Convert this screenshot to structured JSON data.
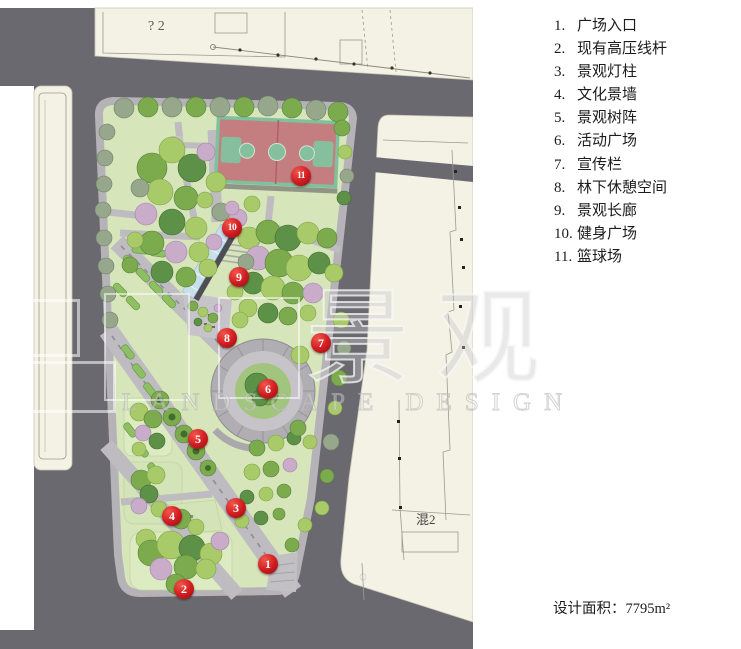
{
  "legend": {
    "items": [
      {
        "num": "1.",
        "label": "广场入口"
      },
      {
        "num": "2.",
        "label": "现有高压线杆"
      },
      {
        "num": "3.",
        "label": "景观灯柱"
      },
      {
        "num": "4.",
        "label": "文化景墙"
      },
      {
        "num": "5.",
        "label": "景观树阵"
      },
      {
        "num": "6.",
        "label": "活动广场"
      },
      {
        "num": "7.",
        "label": "宣传栏"
      },
      {
        "num": "8.",
        "label": "林下休憩空间"
      },
      {
        "num": "9.",
        "label": "景观长廊"
      },
      {
        "num": "10.",
        "label": "健身广场"
      },
      {
        "num": "11.",
        "label": "篮球场"
      }
    ]
  },
  "area_note": "设计面积：7795m²",
  "map": {
    "texts": {
      "q2": "? 2",
      "hun": "混2"
    },
    "watermark": {
      "cn1": "景",
      "cn2": "观",
      "en": "LANDSCAPE DESIGN"
    },
    "markers": [
      {
        "n": "1",
        "x": 268,
        "y": 564,
        "label": "广场入口"
      },
      {
        "n": "2",
        "x": 184,
        "y": 589,
        "label": "现有高压线杆"
      },
      {
        "n": "3",
        "x": 236,
        "y": 508,
        "label": "景观灯柱"
      },
      {
        "n": "4",
        "x": 172,
        "y": 516,
        "label": "文化景墙"
      },
      {
        "n": "5",
        "x": 198,
        "y": 439,
        "label": "景观树阵"
      },
      {
        "n": "6",
        "x": 268,
        "y": 389,
        "label": "活动广场"
      },
      {
        "n": "7",
        "x": 321,
        "y": 343,
        "label": "宣传栏"
      },
      {
        "n": "8",
        "x": 227,
        "y": 338,
        "label": "林下休憩空间"
      },
      {
        "n": "9",
        "x": 239,
        "y": 277,
        "label": "景观长廊"
      },
      {
        "n": "10",
        "x": 232,
        "y": 228,
        "label": "健身广场"
      },
      {
        "n": "11",
        "x": 301,
        "y": 176,
        "label": "篮球场"
      }
    ]
  }
}
